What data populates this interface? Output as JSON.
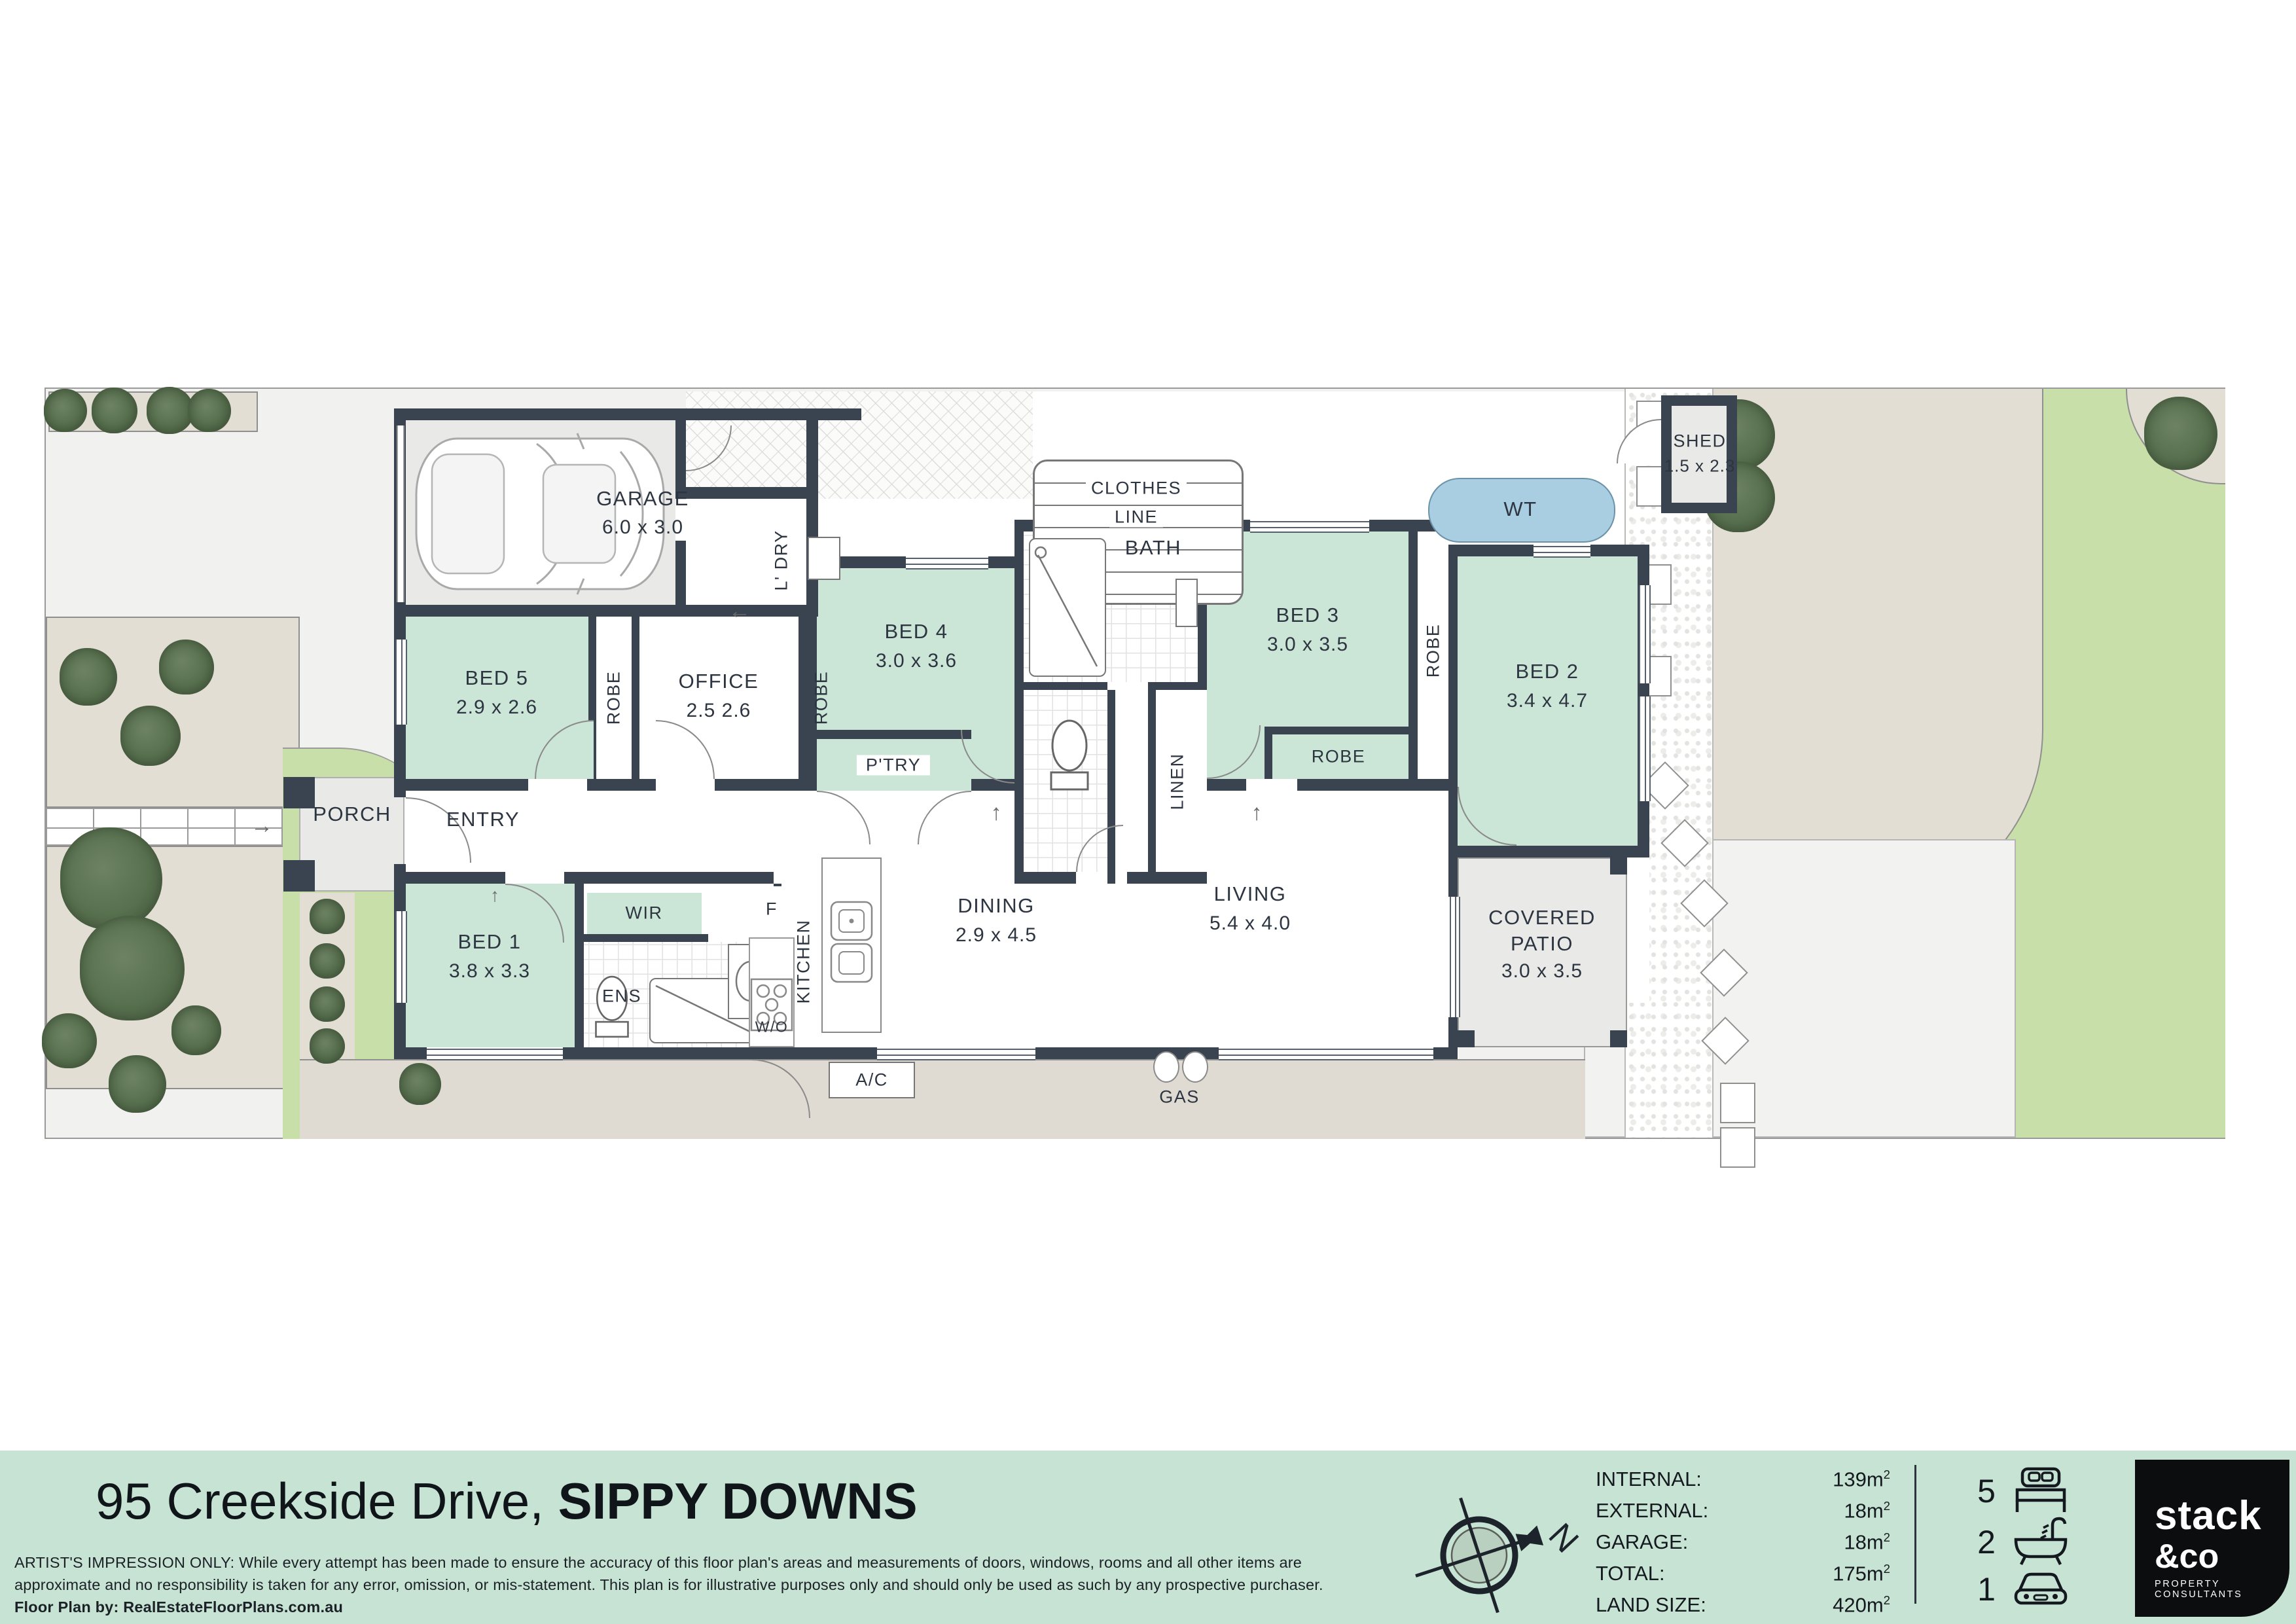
{
  "title": "95 Creekside Drive, SIPPY DOWNS floor plan",
  "footer": {
    "address_regular": "95 Creekside Drive, ",
    "address_bold": "SIPPY DOWNS",
    "disclaimer_line1": "ARTIST'S IMPRESSION ONLY: While every attempt has been made to ensure the accuracy of this floor plan's areas and measurements of doors, windows, rooms and all other items are",
    "disclaimer_line2": "approximate and no responsibility is taken for any error, omission, or mis-statement. This plan is for illustrative purposes only and should only be used as such by any prospective purchaser.",
    "credit": "Floor Plan by: RealEstateFloorPlans.com.au"
  },
  "stats": {
    "rows": [
      {
        "label": "INTERNAL:",
        "value": "139",
        "unit": "m",
        "unit_sup": "2"
      },
      {
        "label": "EXTERNAL:",
        "value": "18",
        "unit": "m",
        "unit_sup": "2"
      },
      {
        "label": "GARAGE:",
        "value": "18",
        "unit": "m",
        "unit_sup": "2"
      },
      {
        "label": "TOTAL:",
        "value": "175",
        "unit": "m",
        "unit_sup": "2"
      },
      {
        "label": "LAND SIZE:",
        "value": "420",
        "unit": "m",
        "unit_sup": "2"
      }
    ]
  },
  "features": {
    "beds": "5",
    "baths": "2",
    "cars": "1"
  },
  "logo": {
    "line1": "stack",
    "line2": "&co",
    "tagline": "PROPERTY CONSULTANTS"
  },
  "compass": {
    "north": "N"
  },
  "colors": {
    "wall": "#3a4450",
    "room_green": "#cbe5d6",
    "grass": "#c9dfa9",
    "water_tank": "#a9cde1",
    "footer_green": "#c7e3d3",
    "logo_black": "#0c0d0e"
  },
  "rooms": {
    "garage": {
      "name": "GARAGE",
      "dims": "6.0 x 3.0"
    },
    "ldry": {
      "name": "L' DRY"
    },
    "bed5": {
      "name": "BED 5",
      "dims": "2.9 x 2.6"
    },
    "office": {
      "name": "OFFICE",
      "dims": "2.5 2.6"
    },
    "bed4": {
      "name": "BED 4",
      "dims": "3.0 x 3.6"
    },
    "bath": {
      "name": "BATH"
    },
    "linen": {
      "name": "LINEN"
    },
    "bed3": {
      "name": "BED 3",
      "dims": "3.0 x 3.5"
    },
    "bed2": {
      "name": "BED 2",
      "dims": "3.4 x 4.7"
    },
    "bed1": {
      "name": "BED 1",
      "dims": "3.8 x 3.3"
    },
    "wir": {
      "name": "WIR"
    },
    "ens": {
      "name": "ENS"
    },
    "kitchen": {
      "name": "KITCHEN"
    },
    "ptry": {
      "name": "P'TRY"
    },
    "dining": {
      "name": "DINING",
      "dims": "2.9 x 4.5"
    },
    "living": {
      "name": "LIVING",
      "dims": "5.4 x 4.0"
    },
    "patio": {
      "name_line1": "COVERED",
      "name_line2": "PATIO",
      "dims": "3.0 x 3.5"
    },
    "porch": {
      "name": "PORCH"
    },
    "entry": {
      "name": "ENTRY"
    },
    "shed": {
      "name": "SHED",
      "dims": "1.5 x 2.3"
    },
    "robe": {
      "name": "ROBE"
    },
    "clothes": {
      "line1": "CLOTHES",
      "line2": "LINE"
    },
    "wt": {
      "name": "WT"
    },
    "fridge": {
      "name": "F"
    },
    "wall_oven": {
      "name": "W/O"
    },
    "ac": {
      "name": "A/C"
    },
    "gas": {
      "name": "GAS"
    }
  },
  "icons": {
    "arrow_up": "↑",
    "arrow_left": "←",
    "arrow_right": "→"
  }
}
